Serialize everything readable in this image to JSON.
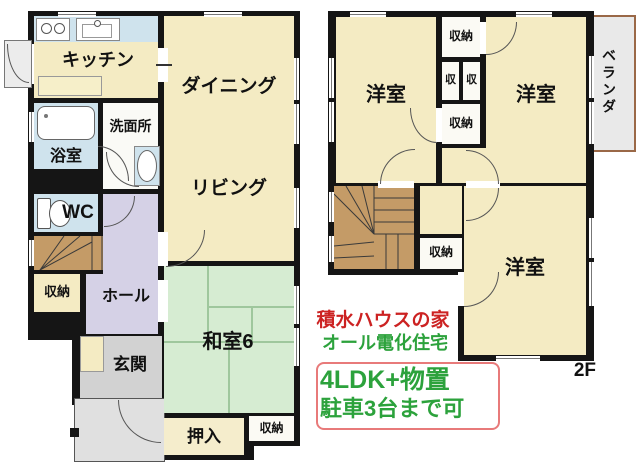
{
  "floor1": {
    "kitchen": "キッチン",
    "dining": "ダイニング",
    "living": "リビング",
    "washroom": "洗面所",
    "bathroom": "浴室",
    "wc": "WC",
    "hall": "ホール",
    "storage_under_stairs": "収納",
    "entrance": "玄関",
    "japanese_room": "和室6",
    "oshiire": "押入",
    "storage_south": "収納"
  },
  "floor2": {
    "west_room_nw": "洋室",
    "west_room_ne": "洋室",
    "west_room_s": "洋室",
    "closet_top": "収納",
    "closet_small_left": "収",
    "closet_small_right": "収",
    "closet_mid": "収納",
    "closet_hall": "収納",
    "veranda": "ベランダ",
    "floor_label": "2F"
  },
  "annotations": {
    "headline": "積水ハウスの家",
    "subheadline": "オール電化住宅",
    "feature_line1": "4LDK+物置",
    "feature_line2": "駐車3台まで可"
  },
  "colors": {
    "room_cream": "#f4ebc3",
    "water_blue": "#cfe3ed",
    "tatami_green": "#d6ecd2",
    "hall_lavender": "#d5d1e6",
    "stairs_brown": "#c49b67",
    "entrance_gray": "#d2d2d2",
    "porch_gray": "#e0e0e0",
    "wall_black": "#151515",
    "headline_red": "#cc2222",
    "feature_green": "#2ca23c",
    "feature_box_border": "#e87a7a",
    "veranda_border": "#9a6847"
  }
}
